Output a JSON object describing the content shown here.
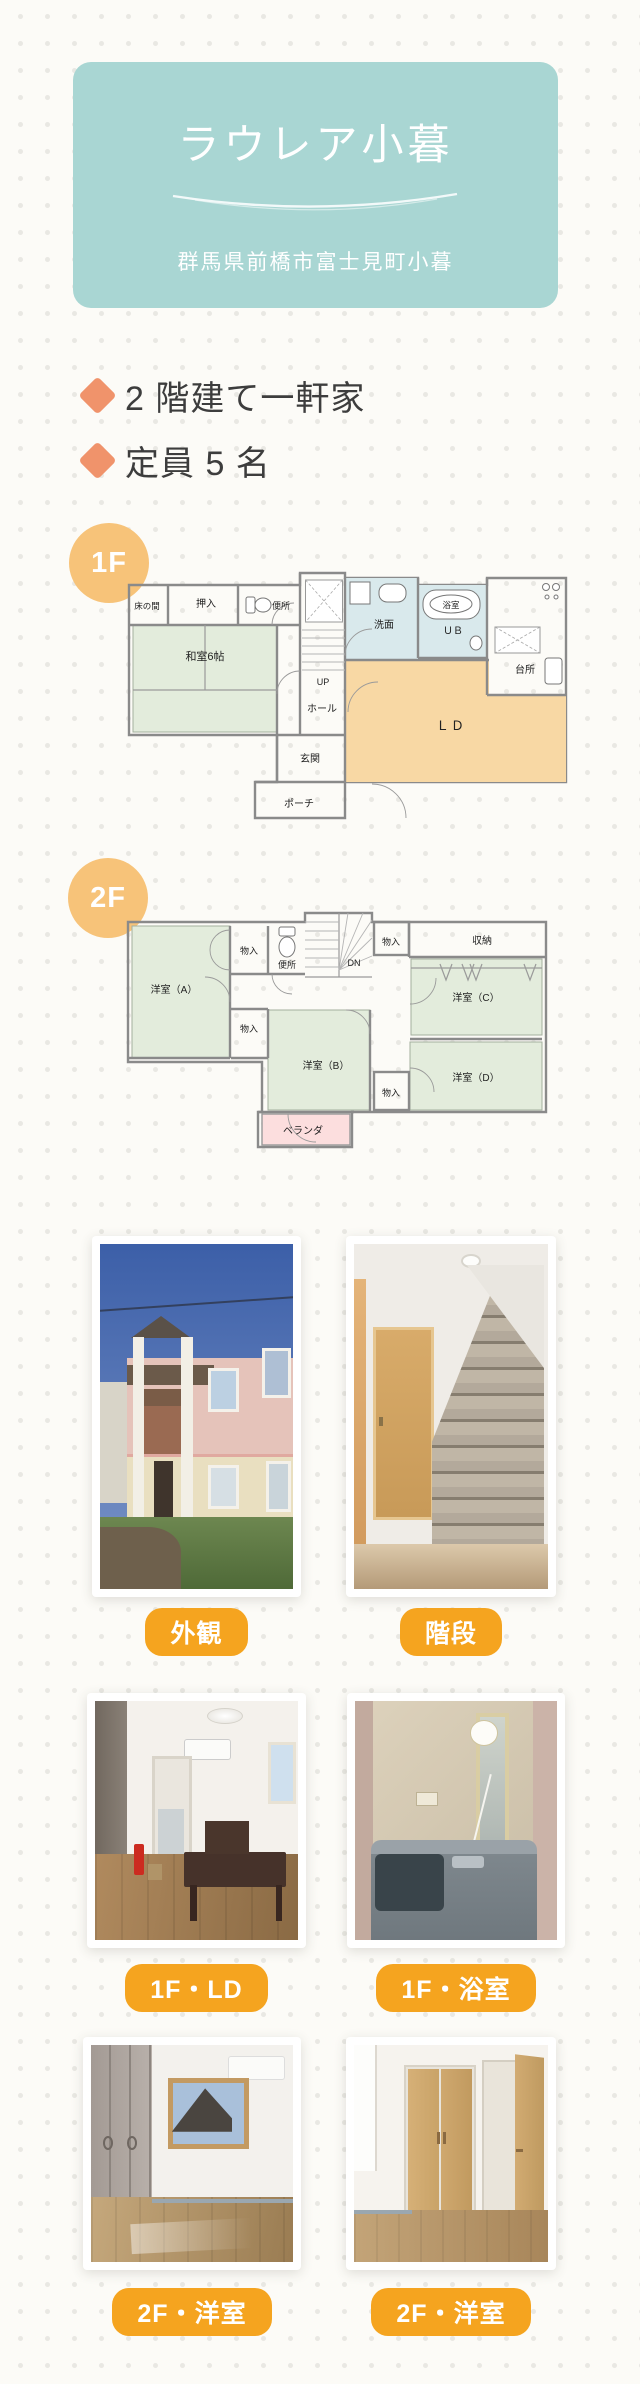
{
  "header": {
    "title": "ラウレア小暮",
    "address": "群馬県前橋市富士見町小暮"
  },
  "features": [
    {
      "text": "2 階建て一軒家"
    },
    {
      "text": "定員 5 名"
    }
  ],
  "floors": [
    {
      "badge": "1F",
      "rooms": [
        {
          "label": "床の間"
        },
        {
          "label": "押入"
        },
        {
          "label": "便所"
        },
        {
          "label": "和室6帖"
        },
        {
          "label": "UP"
        },
        {
          "label": "ホール"
        },
        {
          "label": "洗面"
        },
        {
          "label": "浴室"
        },
        {
          "label": "ＵＢ"
        },
        {
          "label": "台所"
        },
        {
          "label": "ＬＤ"
        },
        {
          "label": "玄関"
        },
        {
          "label": "ポーチ"
        }
      ]
    },
    {
      "badge": "2F",
      "rooms": [
        {
          "label": "洋室（A）"
        },
        {
          "label": "物入"
        },
        {
          "label": "便所"
        },
        {
          "label": "DN"
        },
        {
          "label": "物入"
        },
        {
          "label": "収納"
        },
        {
          "label": "洋室（C）"
        },
        {
          "label": "物入"
        },
        {
          "label": "洋室（B）"
        },
        {
          "label": "物入"
        },
        {
          "label": "洋室（D）"
        },
        {
          "label": "ベランダ"
        }
      ]
    }
  ],
  "photos": [
    {
      "caption": "外観"
    },
    {
      "caption": "階段"
    },
    {
      "caption": "1F・LD"
    },
    {
      "caption": "1F・浴室"
    },
    {
      "caption": "2F・洋室"
    },
    {
      "caption": "2F・洋室"
    }
  ],
  "colors": {
    "header_teal": "#a9d6d3",
    "pill_orange": "#f5a41f",
    "badge_orange": "#f7c379",
    "diamond_orange": "#f0936b",
    "tatami_green": "#e3ecdc",
    "water_blue": "#d9e9ec",
    "ld_orange": "#f8d8a4",
    "veranda_pink": "#fcdede"
  }
}
